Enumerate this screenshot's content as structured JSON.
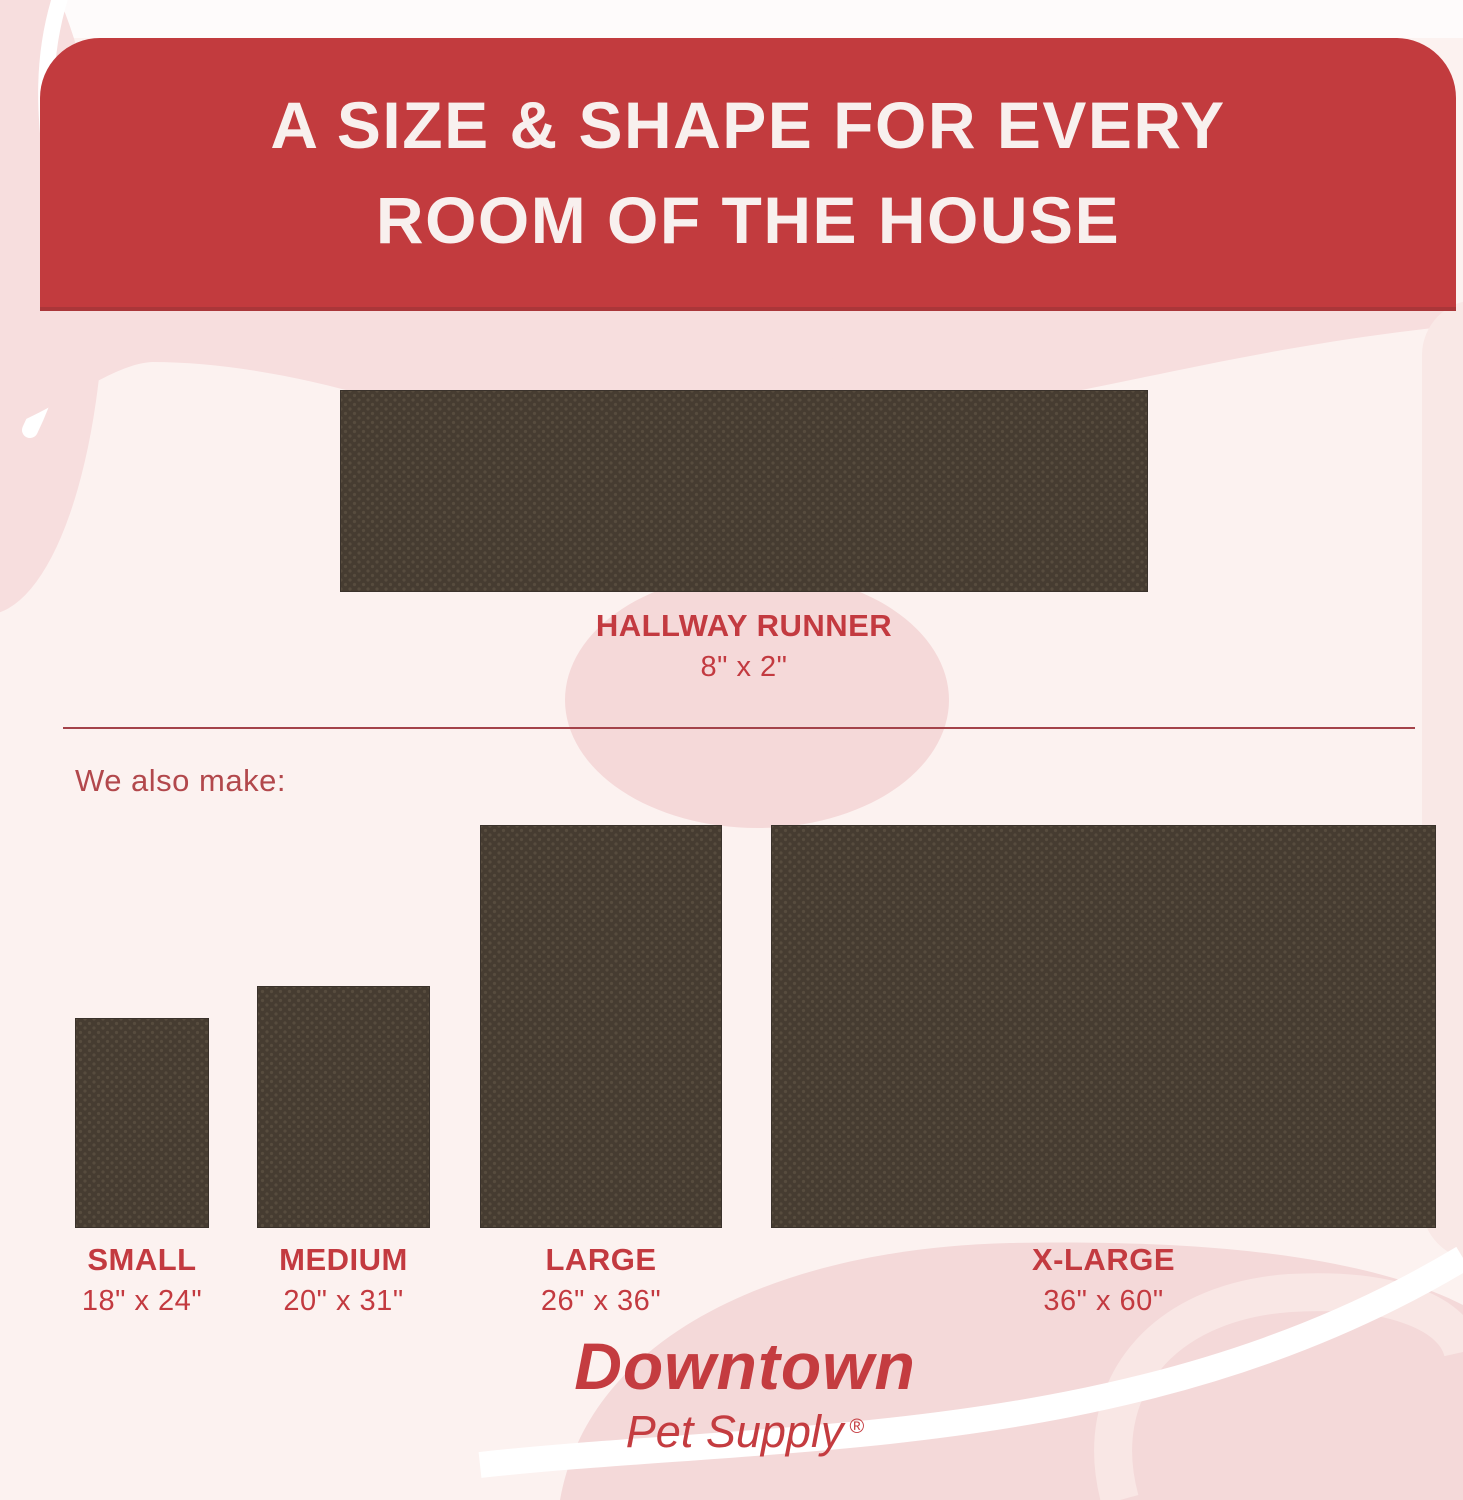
{
  "header": {
    "title_line1": "A SIZE & SHAPE FOR EVERY",
    "title_line2": "ROOM OF THE HOUSE"
  },
  "runner": {
    "name": "HALLWAY RUNNER",
    "dims": "8\" x 2\""
  },
  "also_make_label": "We also make:",
  "sizes": [
    {
      "name": "SMALL",
      "dims": "18\" x 24\""
    },
    {
      "name": "MEDIUM",
      "dims": "20\" x 31\""
    },
    {
      "name": "LARGE",
      "dims": "26\" x 36\""
    },
    {
      "name": "X-LARGE",
      "dims": "36\" x 60\""
    }
  ],
  "brand": {
    "line1": "Downtown",
    "line2": "Pet Supply",
    "registered": "®"
  },
  "colors": {
    "header_red": "#c23b3e",
    "accent_red": "#c33a40",
    "divider_red": "#a4434a",
    "mat_brown": "#463c31",
    "mat_dot": "#574c3e",
    "background": "#fcf2f0",
    "blob_pink": "#f6dcdc"
  }
}
